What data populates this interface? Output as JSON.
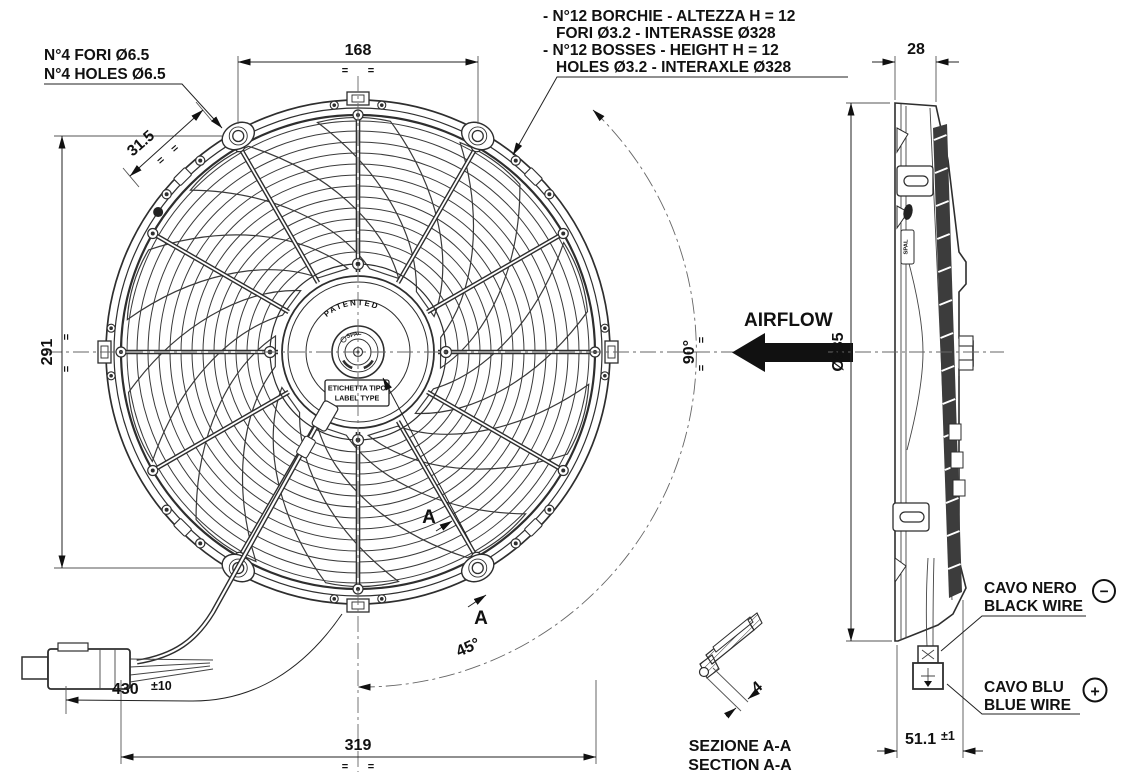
{
  "colors": {
    "ink": "#111111",
    "line": "#2e2e2e",
    "bg": "#ffffff"
  },
  "notes": {
    "holes": {
      "l1": "N°4 FORI Ø6.5",
      "l2": "N°4 HOLES Ø6.5"
    },
    "bosses": {
      "l1": "- N°12 BORCHIE - ALTEZZA H = 12",
      "l2": "FORI Ø3.2 - INTERASSE Ø328",
      "l3": "- N°12 BOSSES - HEIGHT H = 12",
      "l4": "HOLES Ø3.2 - INTERAXLE Ø328"
    }
  },
  "dims": {
    "top_width": "168",
    "left_height": "291",
    "hole_offset": "31.5",
    "bottom_width": "319",
    "wire_len": "430",
    "wire_tol": "±10",
    "depth": "28",
    "diameter": "Ø335",
    "overall_depth": "51.1",
    "overall_depth_tol": "±1",
    "angle_right": "90°",
    "angle_bottom": "45°",
    "boss_height": "4",
    "sym": "="
  },
  "airflow_label": "AIRFLOW",
  "wires": {
    "black": {
      "l1": "CAVO NERO",
      "l2": "BLACK WIRE",
      "polarity": "−"
    },
    "blue": {
      "l1": "CAVO BLU",
      "l2": "BLUE WIRE",
      "polarity": "+"
    }
  },
  "section": {
    "marker": "A",
    "l1": "SEZIONE A-A",
    "l2": "SECTION A-A"
  },
  "hub": {
    "patented": "PATENTED",
    "brand": "SPAL",
    "label_l1": "ETICHETTA TIPO",
    "label_l2": "LABEL TYPE"
  }
}
